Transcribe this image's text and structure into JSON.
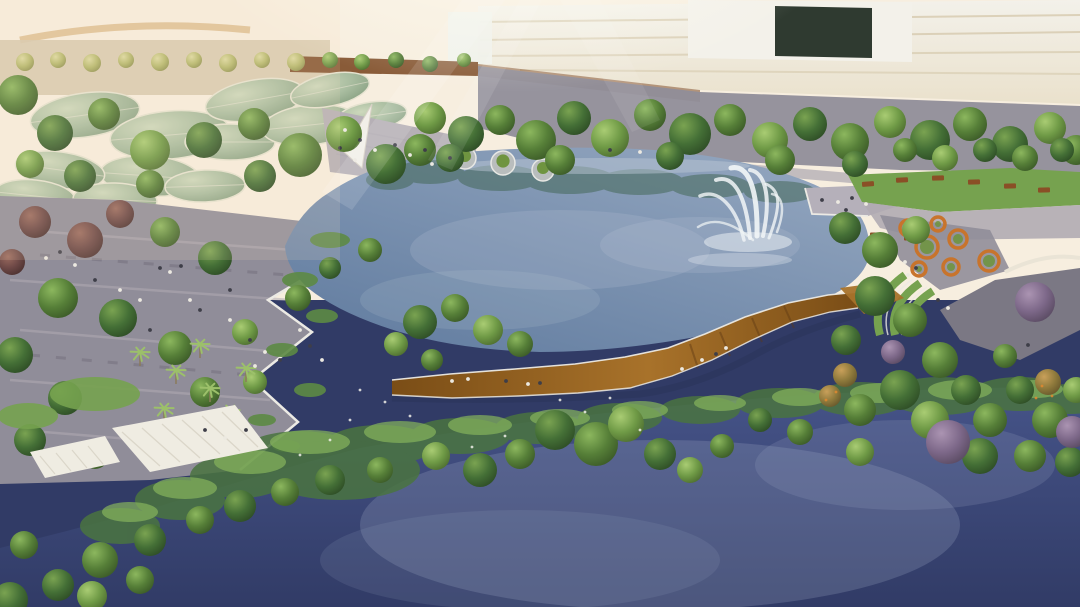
{
  "meta": {
    "description": "Aerial architectural rendering of a lakeside park: central lake with fountain, S-curved wooden boardwalk over wetlands, paved plazas with trees and people, leaf-shaped pavilion roofs, cream office building, orange ring planters and a dark lower lake"
  },
  "palette": {
    "sky": "#f7eedf",
    "skyWarm": "#f6ddb9",
    "roadTan": "#d9b887",
    "buildingFace": "#eae1cc",
    "buildingBand": "#d6c9ae",
    "buildingWhite": "#f3f1ea",
    "buildingOpening": "#2f3a30",
    "glassHouse": "#eef0ea",
    "trackBrown": "#7c4a26",
    "plazaGray": "#908d99",
    "plazaLight": "#b0abb3",
    "plazaDark": "#6e6b78",
    "stepsGray": "#b6b0b6",
    "sailWhite": "#f2efe8",
    "lakeDeep": "#5f7a9e",
    "lakeLight": "#93a6bf",
    "lakeReflection": "#3f6450",
    "lakeShine": "#b9c6d4",
    "pondPlant": "#5d8a44",
    "lawn": "#76a24f",
    "deckGray": "#b5b0ba",
    "pathShade": "#7b7884",
    "railWhite": "#eceae4",
    "woodLight": "#a8722a",
    "woodDark": "#7a4d16",
    "woodShadow": "#5f3a14",
    "fountainWhite": "#f2f6f7",
    "planterOrange": "#c8742c",
    "planterGreen": "#6f9440",
    "wallCream": "#eae4d6",
    "canopyWhite": "#efece2",
    "canopySlat": "#d8d4c6",
    "benchBrown": "#8a4f26",
    "waterTop": "#465489",
    "waterDeep": "#313b66",
    "waterShine": "#9aa5c2",
    "reflGreen": "#4a7440",
    "reflGreenLight": "#86b45c",
    "peopleLight": "#ece9e1",
    "peopleDark": "#3e3e48",
    "palmFrond": "#9cc06a",
    "palmTrunk": "#8a7a5a",
    "podGray": "#b9bdbd",
    "podRim": "#e8e8e4",
    "glare": "#fffdf2",
    "beam": "#ffffff",
    "pavilionRim": "#e6e3d0",
    "trees": {
      "g1": {
        "light": "#7aa351",
        "base": "#446f36",
        "dark": "#2c4a24"
      },
      "g2": {
        "light": "#8cb75e",
        "base": "#567f38",
        "dark": "#395726"
      },
      "g3": {
        "light": "#a9cc73",
        "base": "#6f9a46",
        "dark": "#4b6a2e"
      },
      "gy": {
        "light": "#dcd9a0",
        "base": "#b6b96e",
        "dark": "#8e9150"
      },
      "mr": {
        "light": "#9a6a5e",
        "base": "#6d4846",
        "dark": "#4a302f"
      },
      "pu": {
        "light": "#ab94b2",
        "base": "#7d6889",
        "dark": "#57485f"
      },
      "gor": {
        "light": "#c9a05a",
        "base": "#8f7a3c",
        "dark": "#64552a"
      },
      "leaf": {
        "light": "#cdd8bc",
        "base": "#a9bda0",
        "dark": "#8aa284"
      }
    }
  },
  "scene": {
    "leaves": [
      [
        85,
        115,
        55,
        22,
        -8
      ],
      [
        170,
        135,
        60,
        24,
        -5
      ],
      [
        255,
        100,
        50,
        20,
        -10
      ],
      [
        230,
        142,
        45,
        18,
        0
      ],
      [
        310,
        125,
        48,
        20,
        -6
      ],
      [
        150,
        176,
        50,
        20,
        4
      ],
      [
        60,
        170,
        45,
        18,
        8
      ],
      [
        35,
        196,
        40,
        16,
        6
      ],
      [
        115,
        200,
        42,
        17,
        2
      ],
      [
        205,
        186,
        40,
        16,
        -2
      ],
      [
        330,
        90,
        40,
        16,
        -12
      ],
      [
        372,
        116,
        35,
        14,
        -8
      ]
    ],
    "trees": [
      [
        18,
        95,
        20,
        "g2"
      ],
      [
        55,
        133,
        18,
        "g1"
      ],
      [
        104,
        114,
        16,
        "g2"
      ],
      [
        150,
        150,
        20,
        "g3"
      ],
      [
        204,
        140,
        18,
        "g1"
      ],
      [
        254,
        124,
        16,
        "g2"
      ],
      [
        300,
        155,
        22,
        "g2"
      ],
      [
        344,
        134,
        18,
        "g3"
      ],
      [
        386,
        164,
        20,
        "g1"
      ],
      [
        260,
        176,
        16,
        "g1"
      ],
      [
        150,
        184,
        14,
        "g2"
      ],
      [
        80,
        176,
        16,
        "g1"
      ],
      [
        420,
        150,
        16,
        "g2"
      ],
      [
        30,
        164,
        14,
        "g3"
      ],
      [
        25,
        62,
        9,
        "gy"
      ],
      [
        58,
        60,
        8,
        "gy"
      ],
      [
        92,
        63,
        9,
        "gy"
      ],
      [
        126,
        60,
        8,
        "gy"
      ],
      [
        160,
        62,
        9,
        "gy"
      ],
      [
        194,
        60,
        8,
        "gy"
      ],
      [
        228,
        63,
        9,
        "gy"
      ],
      [
        262,
        60,
        8,
        "gy"
      ],
      [
        296,
        62,
        9,
        "gy"
      ],
      [
        330,
        60,
        8,
        "g3"
      ],
      [
        362,
        62,
        8,
        "g3"
      ],
      [
        396,
        60,
        8,
        "g2"
      ],
      [
        430,
        64,
        8,
        "g2"
      ],
      [
        464,
        60,
        7,
        "g3"
      ],
      [
        430,
        118,
        16,
        "g3"
      ],
      [
        466,
        134,
        18,
        "g1"
      ],
      [
        500,
        120,
        15,
        "g2"
      ],
      [
        536,
        140,
        20,
        "g2"
      ],
      [
        574,
        118,
        17,
        "g1"
      ],
      [
        610,
        138,
        19,
        "g3"
      ],
      [
        650,
        115,
        16,
        "g2"
      ],
      [
        690,
        134,
        21,
        "g1"
      ],
      [
        730,
        120,
        16,
        "g2"
      ],
      [
        770,
        140,
        18,
        "g3"
      ],
      [
        810,
        124,
        17,
        "g1"
      ],
      [
        850,
        142,
        19,
        "g2"
      ],
      [
        890,
        122,
        16,
        "g3"
      ],
      [
        930,
        140,
        20,
        "g1"
      ],
      [
        970,
        124,
        17,
        "g2"
      ],
      [
        1010,
        144,
        18,
        "g1"
      ],
      [
        1050,
        128,
        16,
        "g3"
      ],
      [
        1076,
        150,
        15,
        "g2"
      ],
      [
        450,
        158,
        14,
        "g1"
      ],
      [
        560,
        160,
        15,
        "g2"
      ],
      [
        670,
        156,
        14,
        "g1"
      ],
      [
        780,
        160,
        15,
        "g2"
      ],
      [
        855,
        164,
        13,
        "g1"
      ],
      [
        905,
        150,
        12,
        "g2"
      ],
      [
        985,
        150,
        12,
        "g1"
      ],
      [
        945,
        158,
        13,
        "g3"
      ],
      [
        1025,
        158,
        13,
        "g2"
      ],
      [
        1062,
        150,
        12,
        "g1"
      ],
      [
        35,
        222,
        16,
        "mr"
      ],
      [
        85,
        240,
        18,
        "mr"
      ],
      [
        12,
        262,
        13,
        "mr"
      ],
      [
        120,
        214,
        14,
        "mr"
      ],
      [
        165,
        232,
        15,
        "g2"
      ],
      [
        215,
        258,
        17,
        "g1"
      ],
      [
        58,
        298,
        20,
        "g2"
      ],
      [
        118,
        318,
        19,
        "g1"
      ],
      [
        175,
        348,
        17,
        "g2"
      ],
      [
        245,
        332,
        13,
        "g3"
      ],
      [
        15,
        355,
        18,
        "g1"
      ],
      [
        205,
        392,
        15,
        "g2"
      ],
      [
        65,
        398,
        17,
        "g1"
      ],
      [
        255,
        382,
        12,
        "g3"
      ],
      [
        298,
        298,
        13,
        "g2"
      ],
      [
        330,
        268,
        11,
        "g1"
      ],
      [
        370,
        250,
        12,
        "g2"
      ],
      [
        30,
        440,
        16,
        "g1"
      ],
      [
        95,
        455,
        14,
        "g2"
      ],
      [
        160,
        445,
        13,
        "g1"
      ],
      [
        420,
        322,
        17,
        "g1"
      ],
      [
        455,
        308,
        14,
        "g2"
      ],
      [
        488,
        330,
        15,
        "g3"
      ],
      [
        520,
        344,
        13,
        "g2"
      ],
      [
        396,
        344,
        12,
        "g3"
      ],
      [
        432,
        360,
        11,
        "g2"
      ],
      [
        555,
        430,
        20,
        "g1"
      ],
      [
        596,
        444,
        22,
        "g2"
      ],
      [
        626,
        424,
        18,
        "g3"
      ],
      [
        660,
        454,
        16,
        "g1"
      ],
      [
        520,
        454,
        15,
        "g2"
      ],
      [
        480,
        470,
        17,
        "g1"
      ],
      [
        436,
        456,
        14,
        "g3"
      ],
      [
        380,
        470,
        13,
        "g2"
      ],
      [
        330,
        480,
        15,
        "g1"
      ],
      [
        285,
        492,
        14,
        "g2"
      ],
      [
        240,
        506,
        16,
        "g1"
      ],
      [
        200,
        520,
        14,
        "g2"
      ],
      [
        150,
        540,
        16,
        "g1"
      ],
      [
        100,
        560,
        18,
        "g2"
      ],
      [
        58,
        585,
        16,
        "g1"
      ],
      [
        24,
        545,
        14,
        "g2"
      ],
      [
        690,
        470,
        13,
        "g3"
      ],
      [
        722,
        446,
        12,
        "g2"
      ],
      [
        10,
        600,
        18,
        "g1"
      ],
      [
        92,
        596,
        15,
        "g3"
      ],
      [
        140,
        580,
        14,
        "g2"
      ],
      [
        845,
        228,
        16,
        "g1"
      ],
      [
        880,
        250,
        18,
        "g2"
      ],
      [
        916,
        230,
        14,
        "g3"
      ],
      [
        875,
        296,
        20,
        "g1"
      ],
      [
        910,
        320,
        17,
        "g2"
      ],
      [
        846,
        340,
        15,
        "g1"
      ],
      [
        940,
        360,
        18,
        "g2"
      ],
      [
        900,
        390,
        20,
        "g1"
      ],
      [
        860,
        410,
        16,
        "g2"
      ],
      [
        930,
        420,
        19,
        "g3"
      ],
      [
        966,
        390,
        15,
        "g1"
      ],
      [
        990,
        420,
        17,
        "g2"
      ],
      [
        1020,
        390,
        14,
        "g1"
      ],
      [
        1050,
        420,
        18,
        "g2"
      ],
      [
        1076,
        390,
        13,
        "g3"
      ],
      [
        980,
        456,
        18,
        "g1"
      ],
      [
        1030,
        456,
        16,
        "g2"
      ],
      [
        1070,
        462,
        15,
        "g1"
      ],
      [
        860,
        452,
        14,
        "g3"
      ],
      [
        800,
        432,
        13,
        "g2"
      ],
      [
        760,
        420,
        12,
        "g1"
      ],
      [
        1005,
        356,
        12,
        "g2"
      ],
      [
        1035,
        302,
        20,
        "pu"
      ],
      [
        948,
        442,
        22,
        "pu"
      ],
      [
        1072,
        432,
        16,
        "pu"
      ],
      [
        893,
        352,
        12,
        "pu"
      ],
      [
        1048,
        382,
        13,
        "gor"
      ],
      [
        830,
        396,
        11,
        "gor"
      ],
      [
        845,
        375,
        12,
        "gor"
      ]
    ],
    "palms": [
      [
        140,
        352
      ],
      [
        176,
        370
      ],
      [
        210,
        388
      ],
      [
        246,
        368
      ],
      [
        200,
        344
      ],
      [
        230,
        410
      ],
      [
        164,
        408
      ]
    ],
    "people": [
      [
        160,
        268,
        "d"
      ],
      [
        170,
        272,
        "w"
      ],
      [
        181,
        266,
        "d"
      ],
      [
        140,
        300,
        "w"
      ],
      [
        200,
        310,
        "d"
      ],
      [
        230,
        320,
        "w"
      ],
      [
        250,
        340,
        "d"
      ],
      [
        265,
        352,
        "w"
      ],
      [
        280,
        360,
        "d"
      ],
      [
        255,
        366,
        "w"
      ],
      [
        150,
        330,
        "d"
      ],
      [
        120,
        290,
        "w"
      ],
      [
        95,
        280,
        "d"
      ],
      [
        75,
        265,
        "w"
      ],
      [
        60,
        252,
        "d"
      ],
      [
        46,
        258,
        "w"
      ],
      [
        230,
        290,
        "d"
      ],
      [
        300,
        330,
        "w"
      ],
      [
        310,
        346,
        "d"
      ],
      [
        322,
        360,
        "w"
      ],
      [
        205,
        430,
        "d"
      ],
      [
        225,
        438,
        "w"
      ],
      [
        246,
        430,
        "d"
      ],
      [
        190,
        300,
        "w"
      ],
      [
        345,
        130,
        "w"
      ],
      [
        360,
        140,
        "d"
      ],
      [
        375,
        150,
        "w"
      ],
      [
        395,
        145,
        "d"
      ],
      [
        410,
        155,
        "w"
      ],
      [
        425,
        150,
        "d"
      ],
      [
        355,
        160,
        "w"
      ],
      [
        340,
        148,
        "d"
      ],
      [
        432,
        164,
        "w"
      ],
      [
        450,
        158,
        "d"
      ],
      [
        452,
        381,
        "w"
      ],
      [
        468,
        379,
        "w"
      ],
      [
        506,
        381,
        "d"
      ],
      [
        528,
        384,
        "w"
      ],
      [
        540,
        383,
        "d"
      ],
      [
        682,
        369,
        "w"
      ],
      [
        702,
        360,
        "w"
      ],
      [
        716,
        354,
        "d"
      ],
      [
        726,
        348,
        "w"
      ],
      [
        822,
        200,
        "d"
      ],
      [
        838,
        202,
        "w"
      ],
      [
        852,
        198,
        "d"
      ],
      [
        866,
        204,
        "w"
      ],
      [
        846,
        210,
        "d"
      ],
      [
        905,
        262,
        "w"
      ],
      [
        916,
        268,
        "d"
      ],
      [
        908,
        275,
        "w"
      ],
      [
        938,
        300,
        "d"
      ],
      [
        948,
        308,
        "w"
      ],
      [
        1028,
        345,
        "d"
      ],
      [
        610,
        150,
        "d"
      ],
      [
        640,
        152,
        "w"
      ]
    ],
    "planters": [
      [
        927,
        247,
        11
      ],
      [
        958,
        239,
        9
      ],
      [
        989,
        261,
        10
      ],
      [
        951,
        267,
        8
      ],
      [
        919,
        269,
        7
      ],
      [
        908,
        228,
        8
      ],
      [
        938,
        224,
        7
      ]
    ],
    "benches": [
      [
        868,
        184,
        -4
      ],
      [
        902,
        180,
        -3
      ],
      [
        938,
        178,
        -2
      ],
      [
        974,
        182,
        -2
      ],
      [
        1010,
        186,
        -1
      ],
      [
        1044,
        190,
        -1
      ],
      [
        876,
        235,
        0
      ],
      [
        910,
        238,
        0
      ]
    ],
    "pods": [
      [
        465,
        158,
        11
      ],
      [
        503,
        163,
        12
      ],
      [
        543,
        170,
        11
      ]
    ],
    "dots": [
      [
        360,
        390,
        "w"
      ],
      [
        385,
        402,
        "w"
      ],
      [
        410,
        416,
        "w"
      ],
      [
        350,
        420,
        "w"
      ],
      [
        330,
        440,
        "w"
      ],
      [
        300,
        455,
        "w"
      ],
      [
        560,
        400,
        "w"
      ],
      [
        585,
        412,
        "w"
      ],
      [
        610,
        398,
        "w"
      ],
      [
        640,
        430,
        "w"
      ],
      [
        505,
        436,
        "w"
      ],
      [
        472,
        447,
        "w"
      ],
      [
        1042,
        386,
        "o"
      ],
      [
        1052,
        396,
        "o"
      ],
      [
        1036,
        398,
        "o"
      ],
      [
        836,
        392,
        "o"
      ],
      [
        826,
        400,
        "o"
      ]
    ]
  }
}
